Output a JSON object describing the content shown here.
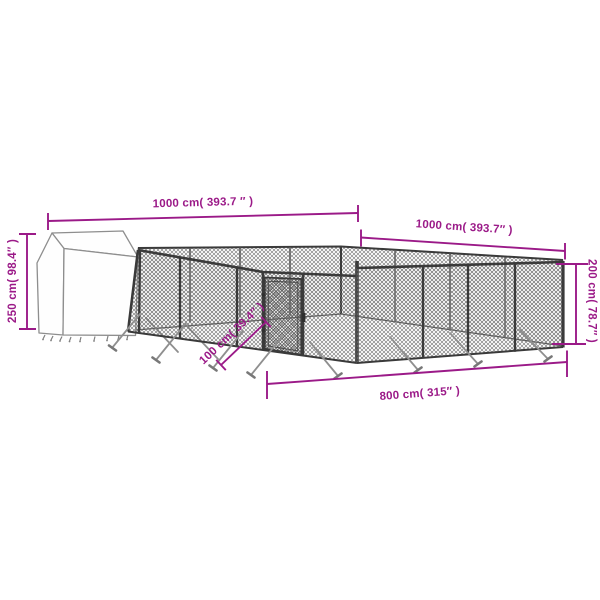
{
  "page": {
    "background": "#ffffff"
  },
  "diagram": {
    "kind": "product-dimension-diagram",
    "subject": "outdoor chain-link dog kennel with covered shelter",
    "accent_color": "#9b1a88",
    "fence_color": "#3a3a3a",
    "mesh_color": "#707070",
    "shelter_color": "#fefefe",
    "dimensions": {
      "top_left_side": "1000 cm( 393.7 ″ )",
      "top_right_side": "1000 cm( 393.7″ )",
      "shelter_height": "250 cm( 98.4″ )",
      "fence_height": "200 cm( 78.7″ )",
      "front_width": "800 cm( 315″ )",
      "door_width": "100 cm( 39.4″ )"
    }
  }
}
